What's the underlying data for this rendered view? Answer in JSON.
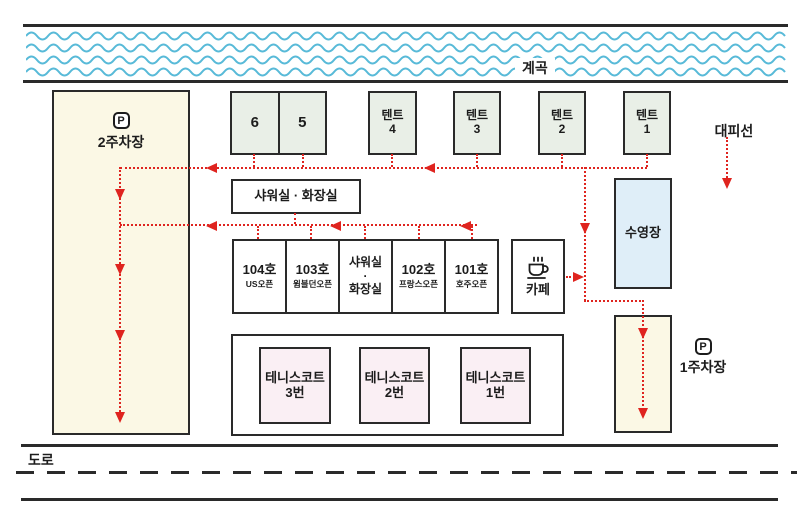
{
  "colors": {
    "border": "#2a2a2a",
    "red": "#df241f",
    "wave": "#58bad8",
    "box_green": "#e9efe7",
    "box_yellow": "#fbf8e5",
    "box_blue": "#dfeef8",
    "box_pink": "#faeff4",
    "background": "#ffffff"
  },
  "stream": {
    "label": "계곡"
  },
  "evacuation": {
    "label": "대피선"
  },
  "parking2": {
    "p_icon": "P",
    "label": "2주차장"
  },
  "parking1": {
    "p_icon": "P",
    "label": "1주차장"
  },
  "sites": [
    {
      "label": "6"
    },
    {
      "label": "5"
    }
  ],
  "tents": [
    {
      "line1": "텐트",
      "line2": "4"
    },
    {
      "line1": "텐트",
      "line2": "3"
    },
    {
      "line1": "텐트",
      "line2": "2"
    },
    {
      "line1": "텐트",
      "line2": "1"
    }
  ],
  "shower_block": {
    "label": "샤워실 · 화장실"
  },
  "rooms": [
    {
      "title": "104호",
      "sub": "US오픈"
    },
    {
      "title": "103호",
      "sub": "윔블던오픈"
    },
    {
      "l1": "샤워실",
      "l2": "·",
      "l3": "화장실"
    },
    {
      "title": "102호",
      "sub": "프랑스오픈"
    },
    {
      "title": "101호",
      "sub": "호주오픈"
    }
  ],
  "cafe": {
    "label": "카페",
    "icon": "coffee-cup"
  },
  "pool": {
    "label": "수영장"
  },
  "tennis_courts": [
    {
      "line1": "테니스코트",
      "line2": "3번"
    },
    {
      "line1": "테니스코트",
      "line2": "2번"
    },
    {
      "line1": "테니스코트",
      "line2": "1번"
    }
  ],
  "road": {
    "label": "도로"
  }
}
